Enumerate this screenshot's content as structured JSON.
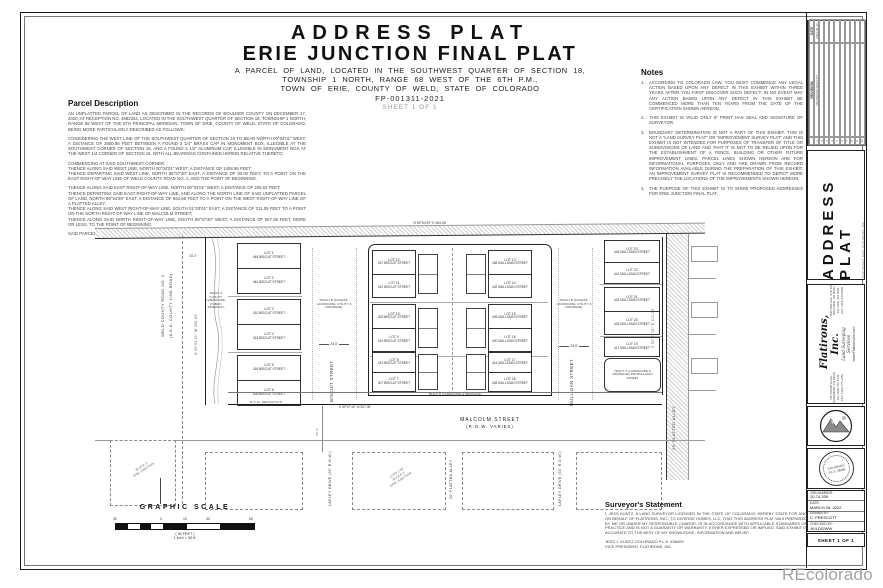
{
  "header": {
    "title1": "ADDRESS PLAT",
    "title2": "ERIE JUNCTION FINAL PLAT",
    "sub1": "A PARCEL OF LAND, LOCATED IN THE SOUTHWEST QUARTER OF SECTION 18,",
    "sub2": "TOWNSHIP 1 NORTH, RANGE 68 WEST OF THE 6TH P.M.,",
    "sub3": "TOWN OF ERIE, COUNTY OF WELD, STATE OF COLORADO",
    "case_no": "FP-001311-2021",
    "sheet": "SHEET 1 OF 1"
  },
  "parcel_description": {
    "heading": "Parcel Description",
    "p1": "AN UNPLATTED PARCEL OF LAND AS DESCRIBED IN THE RECORDS OF BOULDER COUNTY ON DECEMBER 17, 2020, AT RECEPTION NO. 4682334, LOCATED IN THE SOUTHWEST QUARTER OF SECTION 18, TOWNSHIP 1 NORTH, RANGE 68 WEST OF THE 6TH PRINCIPAL MERIDIAN, TOWN OF ERIE, COUNTY OF WELD, STATE OF COLORADO, BEING MORE PARTICULARLY DESCRIBED AS FOLLOWS:",
    "p2": "CONSIDERING THE WEST LINE OF THE SOUTHWEST QUARTER OF SECTION 18 TO BEAR NORTH 00°04'01\" WEST, A DISTANCE OF 2650.86 FEET BETWEEN A FOUND 3 1/4\" BRASS CAP IN MONUMENT BOX, ILLEGIBLE AT THE SOUTHWEST CORNER OF SECTION 18, AND A FOUND 2 1/2\" ALUMINUM CAP, ILLEGIBLE IN MONUMENT BOX AT THE WEST 1/4 CORNER OF SECTION 18, WITH ALL BEARINGS CONTAINED HEREIN RELATIVE THERETO.",
    "p3": "COMMENCING AT SAID SOUTHWEST CORNER:\nTHENCE ALONG SAID WEST LINE, NORTH 00°04'01\" WEST, A DISTANCE OF 1408.86 FEET;\nTHENCE DEPARTING SAID WEST LINE, NORTH 89°57'40\" EAST, A DISTANCE OF 30.00 FEET, TO A POINT ON THE EAST RIGHT-OF-WAY LINE OF WELD COUNTY ROAD NO. 1, AND THE POINT OF BEGINNING.",
    "p4": "THENCE ALONG SAID EAST RIGHT-OF-WAY LINE, NORTH 00°04'01\" WEST, A DISTANCE OF 208.63 FEET;\nTHENCE DEPARTING SAID EAST RIGHT-OF-WAY LINE, AND ALONG THE NORTH LINE OF SAID UNPLATTED PARCEL OF LAND, NORTH 89°54'29\" EAST, A DISTANCE OF 564.68 FEET TO A POINT ON THE WEST RIGHT-OF-WAY LINE OF A PLATTED ALLEY;\nTHENCE ALONG SAID WEST RIGHT-OF-WAY LINE, SOUTH 01°03'01\" EAST, A DISTANCE OF 211.09 FEET TO A POINT ON THE NORTH RIGHT-OF-WAY LINE OF MALCOLM STREET;\nTHENCE ALONG SAID NORTH RIGHT-OF-WAY LINE, SOUTH 89°57'40\" WEST, A DISTANCE OF 567.08 FEET, MORE OR LESS, TO THE POINT OF BEGINNING.",
    "p5": "SAID PARCEL CONTAINING 118,835 SQ. FT., OR 2.73 ACRES, MORE OR LESS."
  },
  "notes": {
    "heading": "Notes",
    "items": [
      {
        "no": "1.",
        "text": "ACCORDING TO COLORADO LAW, YOU MUST COMMENCE ANY LEGAL ACTION BASED UPON ANY DEFECT IN THIS EXHIBIT WITHIN THREE YEARS AFTER YOU FIRST DISCOVER SUCH DEFECT. IN NO EVENT MAY ANY ACTION BASED UPON ANY DEFECT IN THIS EXHIBIT BE COMMENCED MORE THAN TEN YEARS FROM THE DATE OF THE CERTIFICATION SHOWN HEREON."
      },
      {
        "no": "2.",
        "text": "THIS EXHIBIT IS VALID ONLY IF PRINT HAS SEAL AND SIGNATURE OF SURVEYOR."
      },
      {
        "no": "3.",
        "text": "BOUNDARY DETERMINATION IS NOT A PART OF THIS EXHIBIT. THIS IS NOT A \"LAND SURVEY PLAT\" OR \"IMPROVEMENT SURVEY PLAT\" AND THIS EXHIBIT IS NOT INTENDED FOR PURPOSES OF TRANSFER OF TITLE OR SUBDIVISIONS OF LAND AND THAT IT IS NOT TO BE RELIED UPON FOR THE ESTABLISHMENT OF A FENCE, BUILDING OR OTHER FUTURE IMPROVEMENT LINES. PARCEL LINES SHOWN HEREON ARE FOR INFORMATIONAL PURPOSES ONLY AND ARE DRAWN FROM RECORD INFORMATION AVAILABLE DURING THE PREPARATION OF THIS EXHIBIT. AN IMPROVEMENT SURVEY PLAT IS RECOMMENDED TO DEPICT MORE PRECISELY THE LOCATIONS OF THE IMPROVEMENTS SHOWN HEREON."
      },
      {
        "no": "4.",
        "text": "THE PURPOSE OF THIS EXHIBIT IS TO SHOW PROPOSED ADDRESSES FOR ERIE JUNCTION FINAL PLAT."
      }
    ]
  },
  "plat": {
    "west_road_l1": "WELD COUNTY ROAD NO. 1",
    "west_road_l2": "(A.K.A. COUNTY LINE ROAD)",
    "tract_a": "TRACT A (UTILITY, LANDSCAPE, PUBLIC SIDEWALK)",
    "tract_b_w": "TRACT B (ACCESS, LANDSCAPE, UTILITY & DRAINAGE)",
    "tract_b_e": "TRACT B (ACCESS, LANDSCAPE, UTILITY & DRAINAGE)",
    "tract_c": "TRACT C (LANDSCAPE & DRAINAGE) 409 MULLIGAN STREET",
    "tract_d": "TRACT D (LANDSCAPE & DRAINAGE)",
    "biscuit_street": "BISCUIT STREET",
    "mulligan_street": "MULLIGAN STREET",
    "malcolm_l1": "MALCOLM STREET",
    "malcolm_l2": "(R.O.W. VARIES)",
    "alley_east": "20' PLATTED ALLEY",
    "alley_south": "20' PLATTED ALLEY",
    "lapley_w": "LAPLEY DRIVE (60' R.O.W.)",
    "lapley_e": "LAPLEY DRIVE (60' R.O.W.)",
    "row_dedication": "R.O.W. DEDICATION",
    "dim_24_w": "24.0'",
    "dim_24_e": "24.0'",
    "dim_30": "30.0'",
    "dim_40": "40.2'",
    "brg_north": "N 89°54'29\" E  564.68'",
    "brg_west": "N 00°04'01\" W  208.63'",
    "brg_east": "S 01°03'01\" E  211.09'",
    "brg_south": "S 89°57'40\" W  567.08'",
    "diag_sw": "BLOCK 3\nERIE JUNCTION",
    "diag_s": "LOTS 1-16\nBLOCK 2\nERIE JUNCTION",
    "west_lots": [
      {
        "lot": "LOT 1",
        "addr": "448 BISCUIT STREET"
      },
      {
        "lot": "LOT 2",
        "addr": "440 BISCUIT STREET"
      },
      {
        "lot": "LOT 3",
        "addr": "432 BISCUIT STREET"
      },
      {
        "lot": "LOT 4",
        "addr": "424 BISCUIT STREET"
      },
      {
        "lot": "LOT 5",
        "addr": "416 BISCUIT STREET"
      },
      {
        "lot": "LOT 6",
        "addr": "408 BISCUIT STREET"
      }
    ],
    "mid_west_lots": [
      {
        "lot": "LOT 12",
        "addr": "437 BISCUIT STREET"
      },
      {
        "lot": "LOT 11",
        "addr": "431 BISCUIT STREET"
      },
      {
        "lot": "LOT 10",
        "addr": "425 BISCUIT STREET"
      },
      {
        "lot": "LOT 9",
        "addr": "419 BISCUIT STREET"
      },
      {
        "lot": "LOT 8",
        "addr": "413 BISCUIT STREET"
      },
      {
        "lot": "LOT 7",
        "addr": "407 BISCUIT STREET"
      }
    ],
    "mid_east_lots": [
      {
        "lot": "LOT 13",
        "addr": "438 MULLIGAN STREET"
      },
      {
        "lot": "LOT 14",
        "addr": "432 MULLIGAN STREET"
      },
      {
        "lot": "LOT 15",
        "addr": "426 MULLIGAN STREET"
      },
      {
        "lot": "LOT 16",
        "addr": "420 MULLIGAN STREET"
      },
      {
        "lot": "LOT 17",
        "addr": "414 MULLIGAN STREET"
      },
      {
        "lot": "LOT 18",
        "addr": "408 MULLIGAN STREET"
      }
    ],
    "east_lots": [
      {
        "lot": "LOT 23",
        "addr": "449 MULLIGAN STREET"
      },
      {
        "lot": "LOT 22",
        "addr": "441 MULLIGAN STREET"
      },
      {
        "lot": "LOT 21",
        "addr": "433 MULLIGAN STREET"
      },
      {
        "lot": "LOT 20",
        "addr": "425 MULLIGAN STREET"
      },
      {
        "lot": "LOT 19",
        "addr": "417 MULLIGAN STREET"
      }
    ]
  },
  "scale": {
    "heading": "GRAPHIC SCALE",
    "t0": "30",
    "t1": "0",
    "t2": "15",
    "t3": "30",
    "t4": "60",
    "in_feet": "( IN FEET )",
    "inch": "1 inch = 30 ft."
  },
  "surveyor": {
    "heading": "Surveyor's Statement",
    "body": "I, JESS KUNTZ, A LAND SURVEYOR LICENSED IN THE STATE OF COLORADO, HEREBY STATE FOR AND ON BEHALF OF FLATIRONS, INC., TO DIVERGE HOMES, LLC, THAT THIS ADDRESS PLAT WAS PREPARED BY ME OR UNDER MY RESPONSIBLE CHARGE, IS IN ACCORDANCE WITH APPLICABLE STANDARDS OF PRACTICE AND IS NOT A GUARANTY OR WARRANTY, EITHER EXPRESSED OR IMPLIED. SAID EXHIBIT IS ACCURATE TO THE BEST OF MY KNOWLEDGE, INFORMATION AND BELIEF.",
    "sig1": "JESS J. KUNTZ COLORADO P.L.S. #38409",
    "sig2": "VICE PRESIDENT, FLATIRONS, INC"
  },
  "titleblock": {
    "rev_col": "REVISION",
    "date_col": "DATE",
    "rev1_no": "1",
    "rev1_text": "REVISIONS PER CITY",
    "rev1_date": "2022-05-16",
    "rev_nos": [
      "2",
      "3",
      "4",
      "5",
      "6",
      "7",
      "8",
      "9",
      "10"
    ],
    "sheet_title": "ADDRESS PLAT",
    "copyright": "COPYRIGHT 2022, FLATIRONS, INC",
    "firm": "Flatirons, Inc.",
    "firm_sub": "Land Surveying Services",
    "firm_url": "www.FlatironsInc.com",
    "office1": "655 FOURTH AVE.\nLONGMONT, CO 80501\nPH: (303) 776-1733\nFAX: (303) 776-4355",
    "office2": "3825 IRIS AVE, STE 395\nBOULDER, CO 80301\nPH: (303) 443-7001\nFAX: (303) 443-9830",
    "seal_text": "COLORADO P.L.S. 38409",
    "job_label": "JOB NUMBER:",
    "job": "20-74,335",
    "date_label": "DATE:",
    "date": "MARCH 28, 2022",
    "drawn_label": "DRAWN BY:",
    "drawn": "C. PRESCOTT",
    "checked_label": "CHECKED BY:",
    "checked": "JK/LDS/WW",
    "sheet": "SHEET 1 OF 1"
  },
  "watermark": "REcolorado"
}
